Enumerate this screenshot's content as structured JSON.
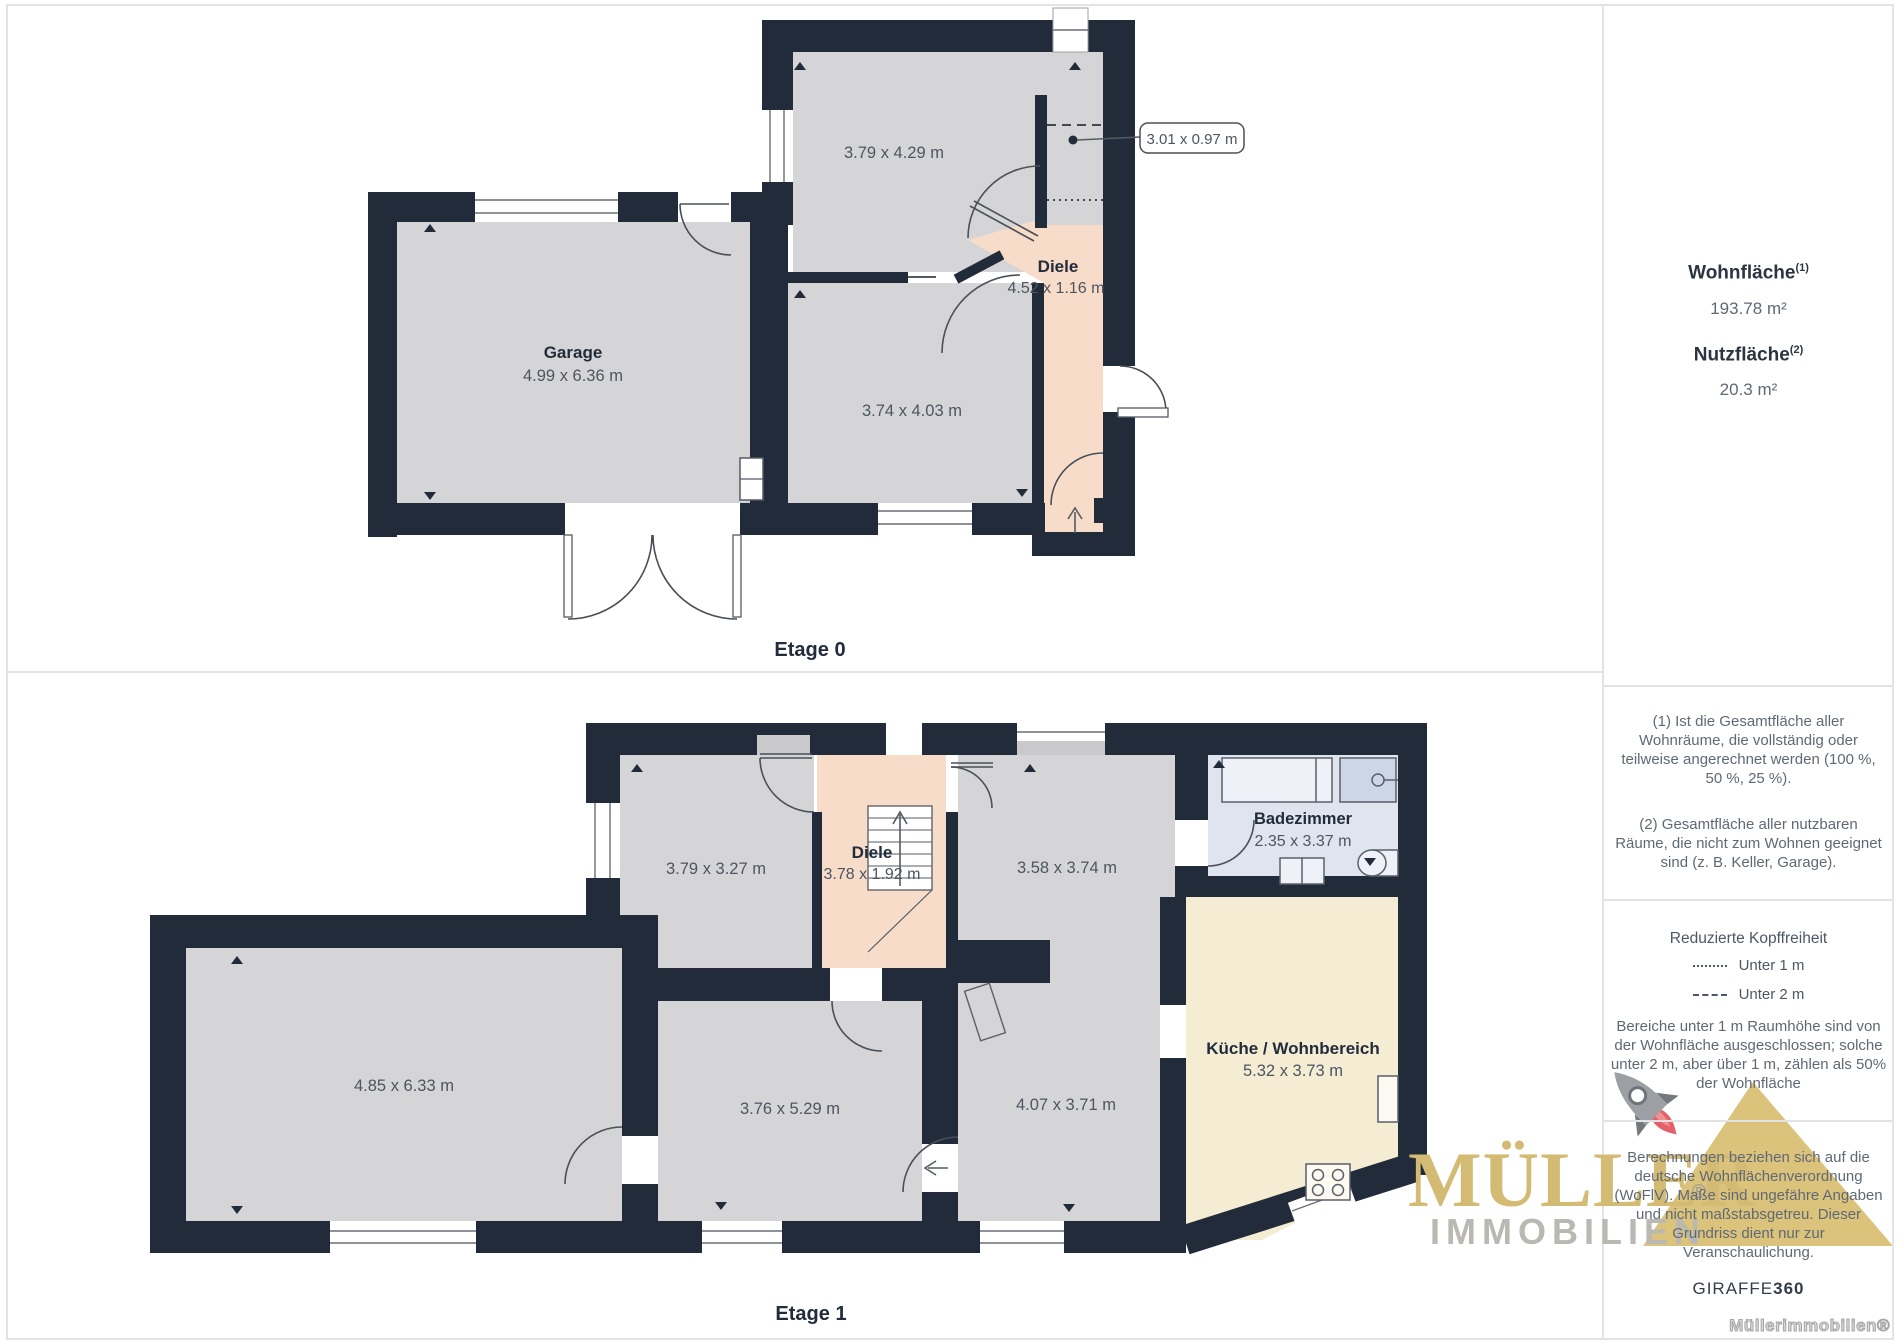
{
  "floors": {
    "etage0": {
      "label": "Etage 0",
      "rooms": {
        "garage_name": "Garage",
        "garage_dims": "4.99 x 6.36 m",
        "room_top_dims": "3.79 x 4.29 m",
        "room_mid_dims": "3.74 x 4.03 m",
        "diele_name": "Diele",
        "diele_dims": "4.52 x 1.16 m",
        "callout_dims": "3.01 x 0.97 m"
      }
    },
    "etage1": {
      "label": "Etage 1",
      "rooms": {
        "room_big_dims": "4.85 x 6.33 m",
        "room_ul_dims": "3.79 x 3.27 m",
        "diele_name": "Diele",
        "diele_dims": "3.78 x 1.92 m",
        "room_um_dims": "3.58 x 3.74 m",
        "bad_name": "Badezimmer",
        "bad_dims": "2.35 x 3.37 m",
        "kueche_name": "Küche / Wohnbereich",
        "kueche_dims": "5.32 x 3.73 m",
        "room_lm_dims": "3.76 x 5.29 m",
        "room_lr_dims": "4.07 x 3.71 m"
      }
    }
  },
  "panel": {
    "area1_label": "Wohnfläche",
    "area1_sup": "(1)",
    "area1_value": "193.78 m²",
    "area2_label": "Nutzfläche",
    "area2_sup": "(2)",
    "area2_value": "20.3 m²",
    "note1": "(1) Ist die Gesamtfläche aller Wohnräume, die vollständig oder teilweise angerechnet werden (100 %, 50 %, 25 %).",
    "note2": "(2) Gesamtfläche aller nutzbaren Räume, die nicht zum Wohnen geeignet sind (z. B. Keller, Garage).",
    "headroom_title": "Reduzierte Kopffreiheit",
    "legend_under1": "Unter 1 m",
    "legend_under2": "Unter 2 m",
    "headroom_text": "Bereiche unter 1 m Raumhöhe sind von der Wohnfläche ausgeschlossen; solche unter 2 m, aber über 1 m, zählen als 50% der Wohnfläche",
    "calc_text": "Berechnungen beziehen sich auf die deutsche Wohnflächenverordnung (WoFlV). Maße sind ungefähre Angaben und nicht maßstabsgetreu. Dieser Grundriss dient nur zur Veranschaulichung.",
    "brand_giraffe": "GIRAFFE",
    "brand_360": "360",
    "watermark": "Müllerimmobilien®"
  },
  "logo": {
    "name": "MÜLLER",
    "reg": "®",
    "sub": "IMMOBILIEN"
  },
  "colors": {
    "wall": "#212b39",
    "room_gray": "#d5d5d7",
    "hallway_peach": "#f7dcc9",
    "bathroom_blue": "#dfe4ef",
    "kitchen_cream": "#f5ecd4",
    "logo_gold": "#d4bb74",
    "logo_gray": "#b9b8b2",
    "flame_red": "#e4606a",
    "text_dark": "#222c3a",
    "text_gray": "#4d5562",
    "divider": "#e3e3e3"
  }
}
